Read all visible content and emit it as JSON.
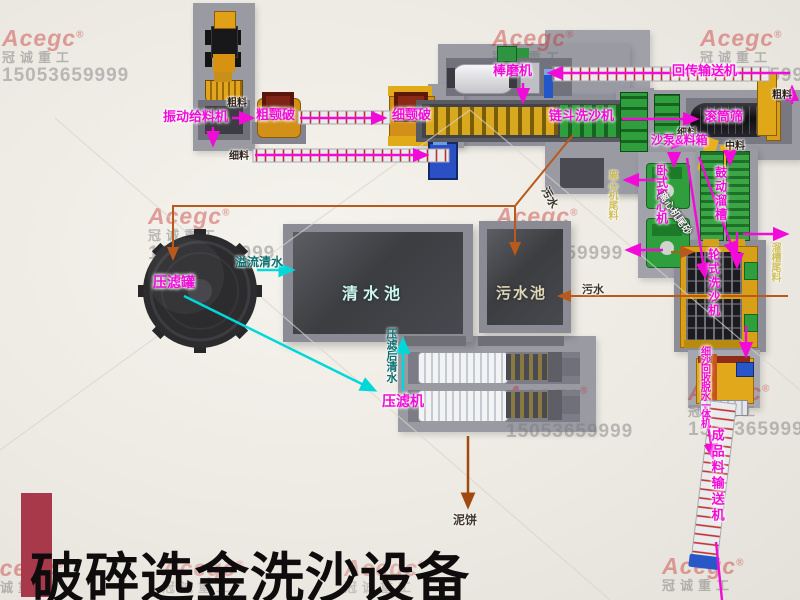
{
  "title": "破碎选金洗沙设备",
  "watermark": {
    "brand": "Acegc",
    "reg": "®",
    "company": "冠诚重工",
    "phone": "15053659999"
  },
  "labels": {
    "vibrating_feeder": "振动给料机",
    "coarse_jaw_crusher": "粗颚破",
    "fine_jaw_crusher": "细颚破",
    "coarse_material_top": "粗料",
    "fine_material_left": "细料",
    "rod_mill": "棒磨机",
    "return_conveyor": "回传输送机",
    "coarse_material_right": "粗料",
    "chain_bucket_washer": "链斗洗沙机",
    "drum_screen": "滚筒筛",
    "fine_material_right": "细料",
    "sand_pump_box": "沙泵&料箱",
    "middle_material": "中料",
    "horizontal_centrifuge": "卧式离心机",
    "vibrating_sluice": "鼓动溜槽",
    "centrifuge_tailing_sand": "离心机尾砂",
    "centrifuge_tailings": "离心机尾料",
    "sluice_tailings": "溜槽尾料",
    "wheel_sand_washer": "轮式洗沙机",
    "fine_sand_recycler": "细沙回收脱水一体机",
    "product_conveyor": "成品料输送机",
    "filter_tank": "压滤罐",
    "overflow_water": "溢流清水",
    "clear_pool": "清水池",
    "sewage_pool": "污水池",
    "water_after_press": "压滤后清水",
    "filter_press": "压滤机",
    "mud_cake": "泥饼",
    "sewage_1": "污水",
    "sewage_2": "污水"
  },
  "colors": {
    "label_accent": "#f20ad8",
    "water_arrow": "#00d8d8",
    "slurry_arrow": "#b9591b",
    "mud_arrow": "#a14a10",
    "watermark_red": "#c62c2c",
    "title_bar": "#a8394b"
  }
}
